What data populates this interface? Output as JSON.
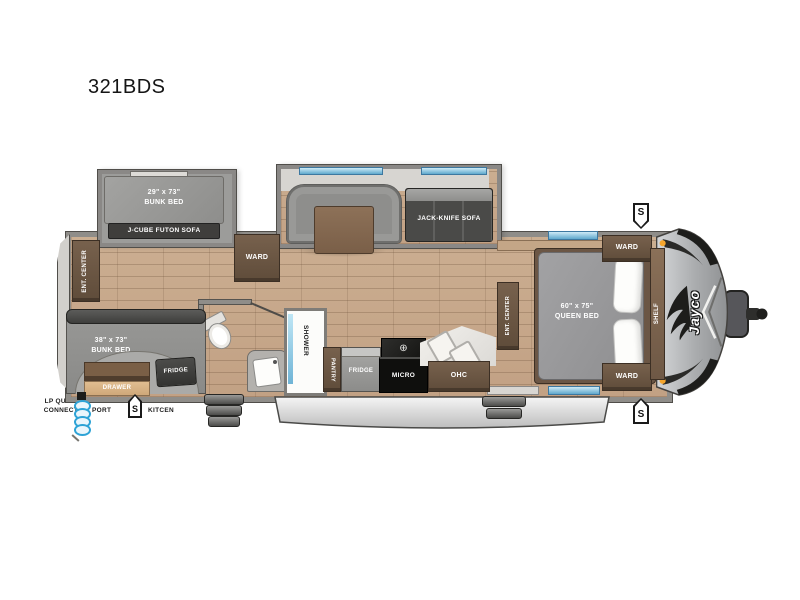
{
  "model": "321BDS",
  "brand": {
    "logo": "Jayco"
  },
  "badges": {
    "s": "S"
  },
  "icons": {
    "burner": "⊕"
  },
  "colors": {
    "floor_wood": "#c9ad90",
    "wall_gray": "#8f8d89",
    "cabinet_brown": "#6b5645",
    "mattress_gray": "#9a9a98",
    "window_blue": "#8fd0ec",
    "sofa_dark": "#4a4a48",
    "awning_gray": "#d9d9d9",
    "marker_orange": "#f5a52c",
    "hose_blue": "#2ea3d6"
  },
  "rear_slide": {
    "bed_size": "29\" x 73\"",
    "bed_name": "BUNK BED",
    "sofa": "J-CUBE FUTON SOFA"
  },
  "rear": {
    "ent_center": "ENT. CENTER",
    "ward": "WARD"
  },
  "dinette": {
    "sofa": "JACK-KNIFE SOFA"
  },
  "outside_kitchen": {
    "bed_size": "38\" x 73\"",
    "bed_name": "BUNK BED",
    "fridge": "FRIDGE",
    "drawer": "DRAWER"
  },
  "bath": {
    "shower": "SHOWER"
  },
  "kitchen": {
    "pantry": "PANTRY",
    "fridge": "FRIDGE",
    "micro": "MICRO",
    "ohc": "OHC"
  },
  "bedroom": {
    "ent_center": "ENT. CENTER",
    "bed_size": "60\" x 75\"",
    "bed_name": "QUEEN BED",
    "ward_top": "WARD",
    "ward_bottom": "WARD",
    "shelf": "SHELF"
  },
  "exterior": {
    "awning": "18' AWNING",
    "lp_line1": "LP QUICK",
    "lp_line2": "CONNECT",
    "spray_line1": "SPRAY",
    "spray_line2": "PORT",
    "ok_line1": "OUTSIDE",
    "ok_line2": "KITCEN"
  }
}
